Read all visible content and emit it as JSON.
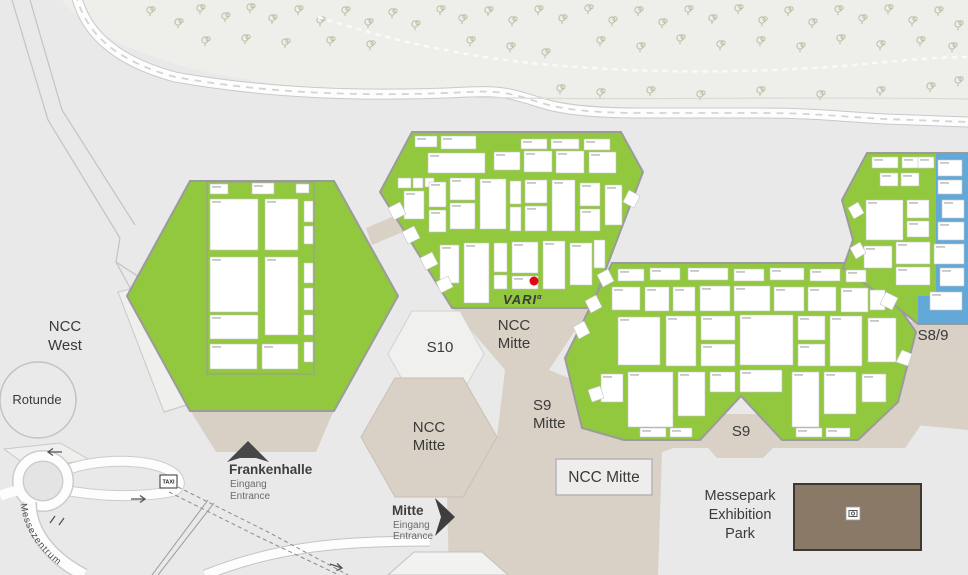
{
  "labels": {
    "ncc_west": {
      "line1": "NCC",
      "line2": "West"
    },
    "rotunde": "Rotunde",
    "s10": "S10",
    "ncc_mitte_upper": {
      "line1": "NCC",
      "line2": "Mitte"
    },
    "s9_mitte": {
      "line1": "S9",
      "line2": "Mitte"
    },
    "ncc_mitte_hex": {
      "line1": "NCC",
      "line2": "Mitte"
    },
    "ncc_mitte_box": "NCC Mitte",
    "s9": "S9",
    "s8_9": "S8/9",
    "messepark": {
      "line1": "Messepark",
      "line2": "Exhibition",
      "line3": "Park"
    }
  },
  "entrances": {
    "frankenhalle": {
      "name": "Frankenhalle",
      "eingang": "Eingang",
      "entrance": "Entrance"
    },
    "mitte": {
      "name": "Mitte",
      "eingang": "Eingang",
      "entrance": "Entrance"
    }
  },
  "street_name": "Messezentrum",
  "taxi_label": "TAXI",
  "exhibitor": {
    "logo_text": "VARI",
    "logo_superscript": "α"
  },
  "colors": {
    "hall_green": "#92c83e",
    "hall_blue": "#62a9d8",
    "connector_beige": "#d9d0c6",
    "entrance_beige": "#d8cfc5",
    "park_brown": "#8a7966",
    "logo_red": "#d6191f",
    "marker_red": "#e30613"
  }
}
